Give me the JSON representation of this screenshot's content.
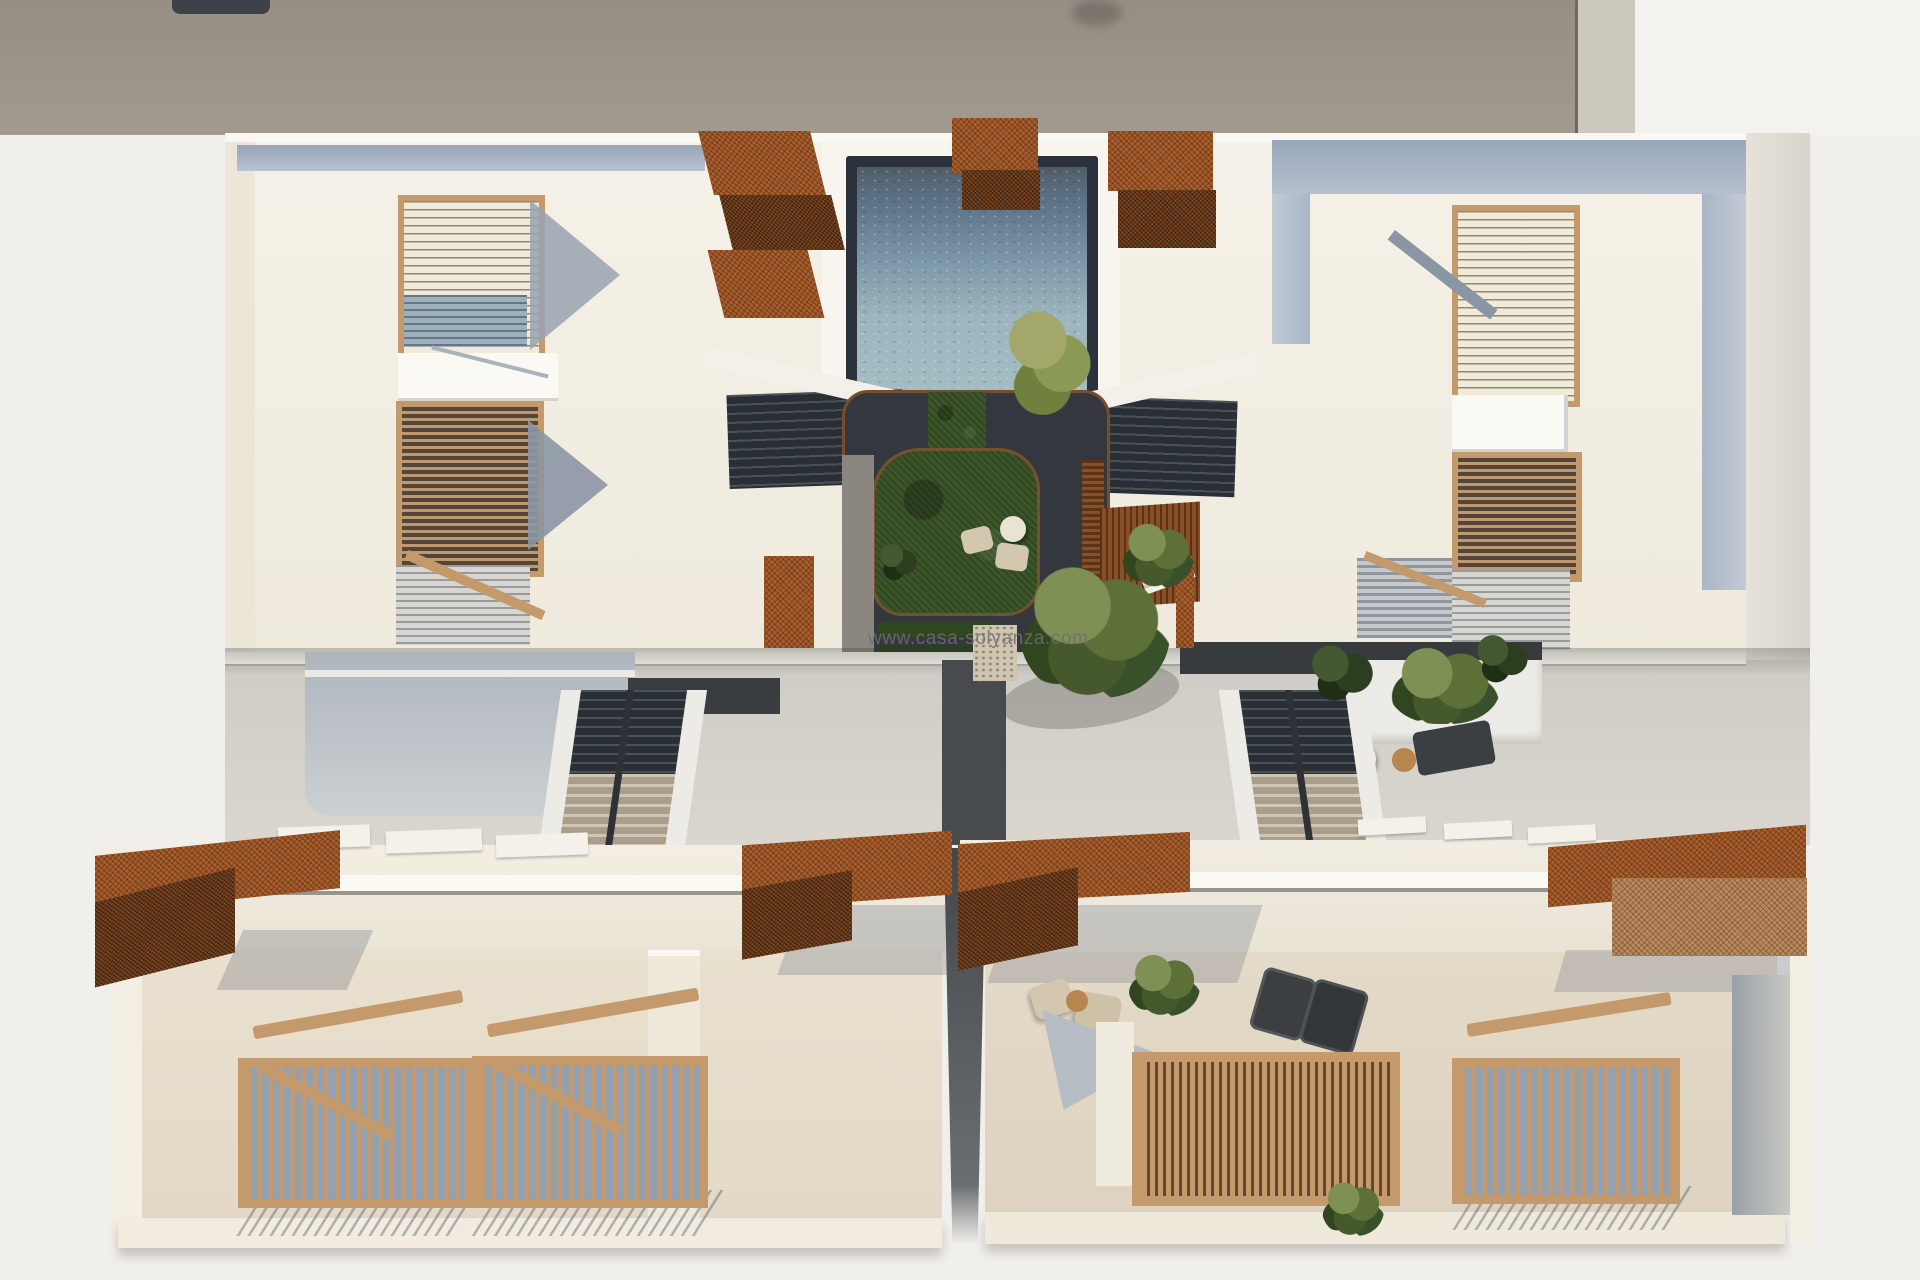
{
  "scene": {
    "type": "aerial-architectural-render",
    "description": "top-down 3D render of a two-wing residential building with central pool courtyard, garden, stairs and roof terraces",
    "watermark": "www.casa-solyanza.com"
  },
  "palette": {
    "background": "#f1efec",
    "roof_taupe": "#968e82",
    "roof_light_strip": "#cdc8be",
    "roof_white": "#f3f2ef",
    "chimney": "#3c4248",
    "building_cream": "#f2eee3",
    "parapet_white": "#faf8f2",
    "blue_band": "#a3b0c2",
    "corten": "#a85e2c",
    "corten_dark": "#7c4620",
    "wood_tan": "#c49a6c",
    "louver_dark": "#544737",
    "pool_frame": "#2b323c",
    "pool_water_top": "#5c7286",
    "pool_water_mid": "#7e99aa",
    "pool_water_low": "#a6bfc5",
    "grass_green": "#3c5629",
    "patio_dark": "#34383e",
    "pavement": "#d5d1ca",
    "wall_blue_face": "#b7bdc5",
    "stair_dark": "#2e3339",
    "stair_beige": "#c9bfae",
    "terrace_floor": "#e9e0cf",
    "furniture_beige": "#d3c7af",
    "furniture_dark": "#3b3f42",
    "table_wood": "#b9854e",
    "plant_green": "#5c6f3d",
    "watermark_gray": "#6e6e6e"
  }
}
